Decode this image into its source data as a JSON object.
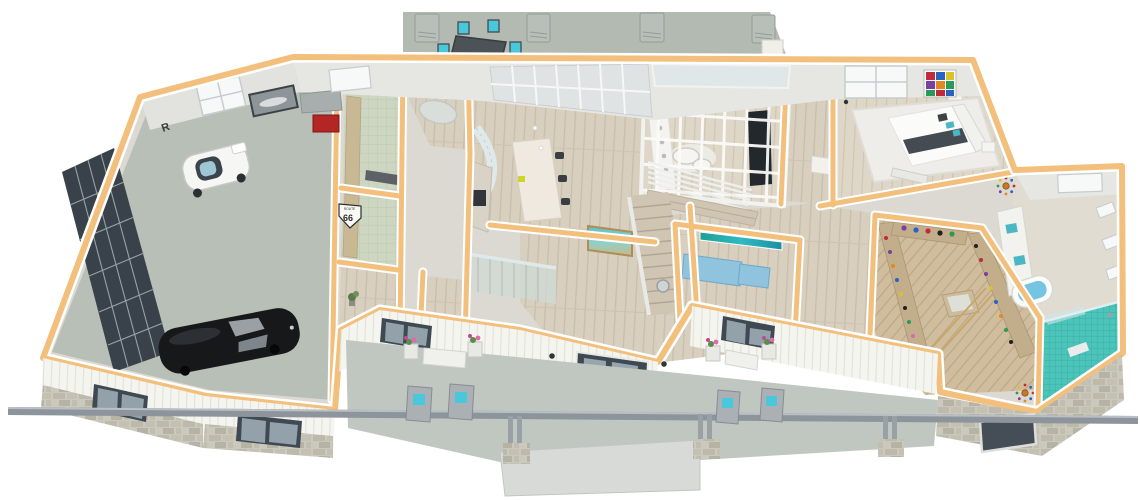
{
  "image": {
    "type": "3d-floor-plan-render",
    "style": "isometric dollhouse cutaway of a single-story home, first floor",
    "background": "#ffffff"
  },
  "palette": {
    "wall_cut_top": "#f2c07c",
    "wall_face": "#e6e6e3",
    "wood_floor": "#d8cfbf",
    "closet_wood": "#cdbb9b",
    "garage_concrete": "#b7bfb7",
    "patio_concrete": "#b3bab2",
    "porch_slab": "#c0c6c0",
    "laundry_tile_green": "#ccd6c1",
    "accent_cyan": "#49c8dc",
    "cabinet_blue": "#8fc3de",
    "shower_teal": "#4cc4ba",
    "tub_water": "#74c4e2",
    "exterior_siding": "#f5f5f0",
    "stone_veneer": "#cbc8bd",
    "window_frame_dark": "#3f4952",
    "roof_beam_gray": "#8d949b",
    "car_black": "#16181a",
    "cart_white": "#f6f6f4",
    "flower_pink": "#e06aa8"
  },
  "signage": {
    "route_shield_word": "ROUTE",
    "route_shield_number": "66",
    "garage_wall_logo": "R"
  },
  "rooms": [
    {
      "id": "garage",
      "name": "Garage",
      "floor": "concrete"
    },
    {
      "id": "mudroom",
      "name": "Mudroom",
      "floor": "green tile"
    },
    {
      "id": "laundry",
      "name": "Laundry",
      "floor": "green tile"
    },
    {
      "id": "hall-bath",
      "name": "Hall / Powder Room",
      "floor": "wood"
    },
    {
      "id": "rear-corridor",
      "name": "Rear Entry Corridor",
      "floor": "wood"
    },
    {
      "id": "kitchen",
      "name": "Kitchen",
      "floor": "wood"
    },
    {
      "id": "sunken-living",
      "name": "Sunken Living Room (glass atrium)",
      "floor": "wood"
    },
    {
      "id": "foyer",
      "name": "Foyer / Great Room",
      "floor": "wood"
    },
    {
      "id": "stairs",
      "name": "Basement Staircase (L-shaped)",
      "floor": "wood"
    },
    {
      "id": "office",
      "name": "Office / Den",
      "floor": "wood"
    },
    {
      "id": "master-hall",
      "name": "Master Hallway",
      "floor": "wood"
    },
    {
      "id": "master-bedroom",
      "name": "Master Bedroom",
      "floor": "wood"
    },
    {
      "id": "walk-in-closet",
      "name": "Walk-in Closet",
      "floor": "wood"
    },
    {
      "id": "master-bath",
      "name": "Master Bathroom",
      "floor": "tile"
    },
    {
      "id": "walk-in-shower",
      "name": "Walk-in Shower",
      "floor": "teal mosaic"
    },
    {
      "id": "rear-patio",
      "name": "Rear Patio",
      "floor": "concrete"
    },
    {
      "id": "front-porch",
      "name": "Front Porch",
      "floor": "concrete"
    }
  ],
  "objects": {
    "garage": [
      "black classic sports car",
      "white micro golf cart",
      "glass-panel garage door",
      "framed car picture",
      "red tool chest",
      "gray workbench",
      "window",
      "R wall logo",
      "Route 66 shield sign"
    ],
    "mudroom": [
      "tall cabinets",
      "dark bench",
      "swirl rug"
    ],
    "kitchen": [
      "marble waterfall island",
      "3 dark bar stools",
      "yellow cutting board",
      "cooktop counter",
      "curved glass-block pantry wall",
      "French door wall",
      "framed seascape art"
    ],
    "sunken-living": [
      "white beam glass atrium frame",
      "white banquette sofas",
      "two oval coffee tables",
      "dark media wall TV",
      "horizontal-slat railing",
      "wide wood steps"
    ],
    "foyer": [
      "front door with glass",
      "two wall sconces",
      "round wall mirror",
      "glass stair balustrade"
    ],
    "office": [
      "light-blue built-in cabinets",
      "teal panoramic artwork"
    ],
    "master-bedroom": [
      "bed with white duvet and dark throw",
      "teal accent pillows",
      "tufted headboard",
      "nightstands",
      "foot bench",
      "white shag rug",
      "multicolor artwork",
      "windows"
    ],
    "walk-in-closet": [
      "shoe shelves with colorful shoes",
      "hanging clothes",
      "center island with glass top",
      "wood ladder"
    ],
    "master-bath": [
      "double vanity with teal sinks",
      "freestanding tub with water",
      "starburst wall decor x2",
      "windows"
    ],
    "walk-in-shower": [
      "teal mosaic tile",
      "glass panel",
      "shower fixture"
    ],
    "rear-patio": [
      "outdoor dining table",
      "6 cyan-cushion chairs",
      "lounge chair",
      "4 AC units",
      "white chimney"
    ],
    "front-porch": [
      "roof edge beam",
      "3 column pairs on stone bases",
      "2 white benches",
      "4 flower planters",
      "4 adirondack chairs with cyan cushions",
      "2 dark-frame windows"
    ]
  },
  "exterior": [
    "white vertical board siding",
    "stone veneer wainscot",
    "dark-framed windows",
    "dark glass panel on right wing",
    "concrete stoop"
  ]
}
